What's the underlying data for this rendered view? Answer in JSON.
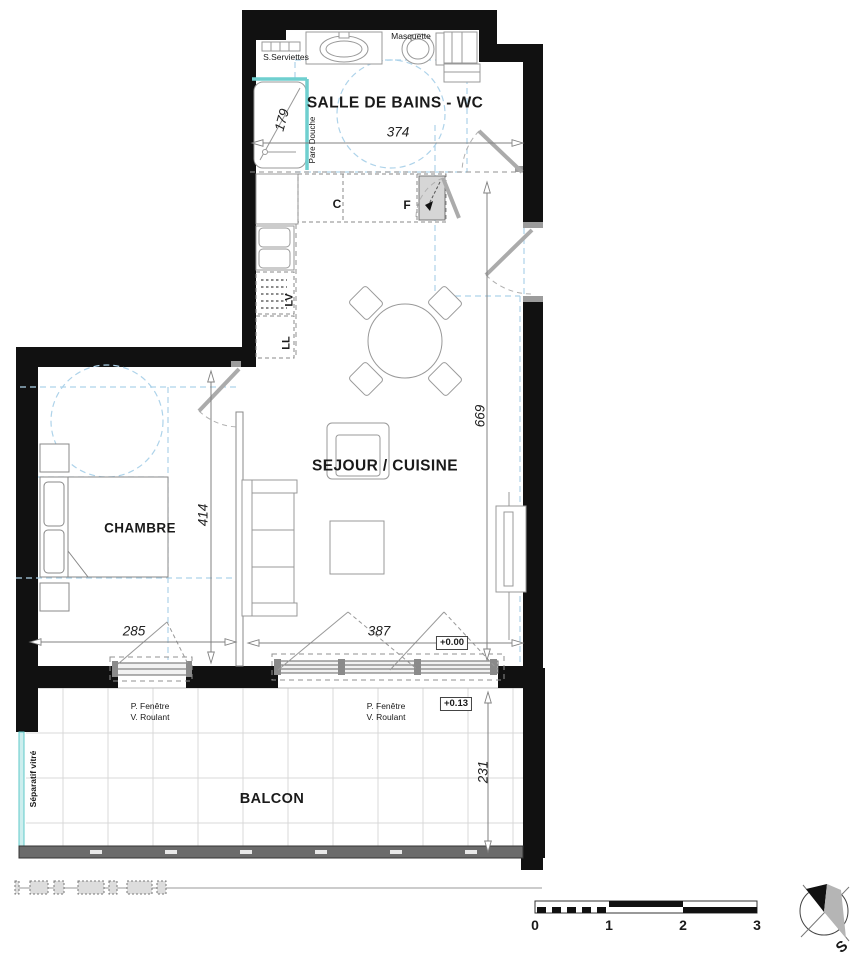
{
  "rooms": {
    "bathroom": "SALLE DE BAINS - WC",
    "living_kitchen": "SEJOUR / CUISINE",
    "bedroom": "CHAMBRE",
    "balcony": "BALCON"
  },
  "fixtures": {
    "masquette": "Masquette",
    "towel_dryer": "S.Serviettes",
    "shower_screen": "Pare Douche",
    "cooktop": "C",
    "fridge": "F",
    "dishwasher": "LV",
    "washing_machine": "LL",
    "glass_divider": "Séparatif vitré"
  },
  "windows": {
    "label_line1": "P. Fenêtre",
    "label_line2": "V. Roulant"
  },
  "dimensions_cm": {
    "bathroom_width": "374",
    "shower_diagonal": "179",
    "living_length": "669",
    "bedroom_length": "414",
    "bedroom_width": "285",
    "living_width": "387",
    "balcony_depth": "231"
  },
  "levels": {
    "interior": "+0.00",
    "balcony": "+0.13"
  },
  "scale_bar": {
    "ticks": [
      "0",
      "1",
      "2",
      "3"
    ]
  },
  "compass": {
    "south_label": "S"
  },
  "colors": {
    "wall": "#111111",
    "door": "#ababab",
    "glass_teal": "#6fcfcf",
    "accessibility_blue": "#aed3ea",
    "railing": "#6b6b6b",
    "furniture_line": "#999999"
  }
}
